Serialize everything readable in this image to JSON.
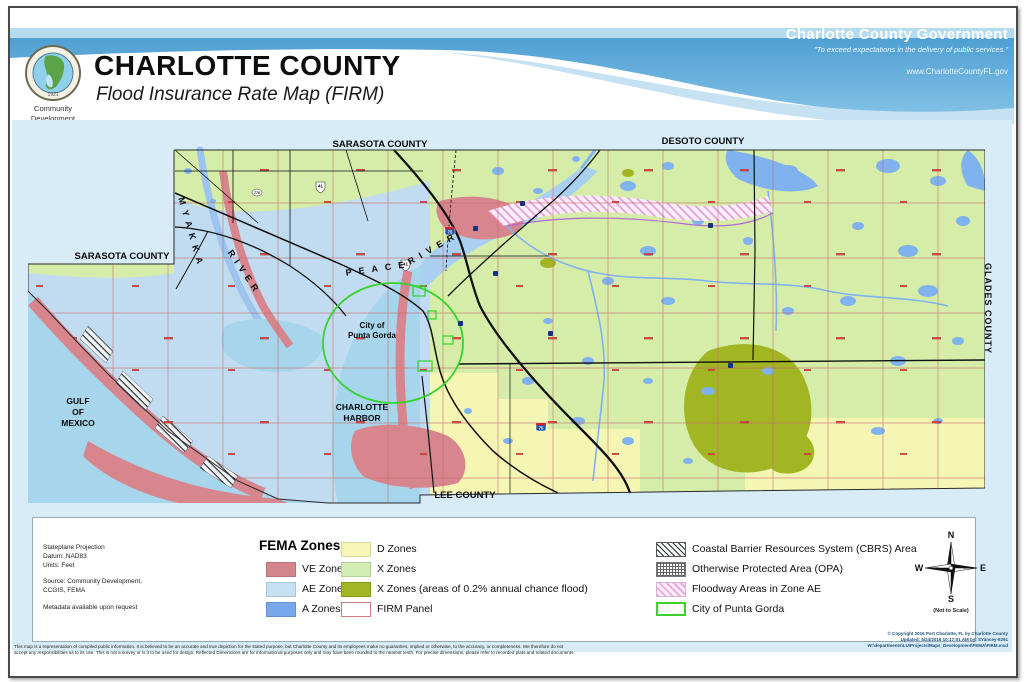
{
  "header": {
    "title": "CHARLOTTE COUNTY",
    "subtitle": "Flood Insurance Rate Map (FIRM)",
    "gov_title": "Charlotte County Government",
    "tagline": "\"To exceed expectations in the delivery of public services.\"",
    "website": "www.CharlotteCountyFL.gov",
    "logo_caption_line1": "Community",
    "logo_caption_line2": "Development",
    "seal_year": "1921"
  },
  "map": {
    "labels": {
      "sarasota_top": "SARASOTA COUNTY",
      "desoto": "DESOTO COUNTY",
      "sarasota_west": "SARASOTA COUNTY",
      "glades": "GLADES COUNTY",
      "lee": "LEE COUNTY",
      "gulf": "GULF\nOF\nMEXICO",
      "harbor": "CHARLOTTE\nHARBOR",
      "punta_gorda": "City of\nPunta Gorda",
      "myakka_word1": "MYAKKA",
      "myakka_word2": "RIVER",
      "peace_word1": "PEACE",
      "peace_word2": "RIVER"
    },
    "shields": {
      "us41": "41",
      "i75": "75",
      "sr776": "776"
    }
  },
  "legend": {
    "heading": "FEMA Zones",
    "info": {
      "projection": "Stateplane Projection",
      "datum": "Datum: NAD83",
      "units": "Units:  Feet",
      "source_line1": "Source: Community Development,",
      "source_line2": "CCGIS, FEMA",
      "metadata": "Metadata available upon request"
    },
    "col1": [
      {
        "label": "VE Zones",
        "color": "#d3858c"
      },
      {
        "label": "AE Zones",
        "color": "#c6e1f4"
      },
      {
        "label": "A Zones",
        "color": "#77a8ee"
      }
    ],
    "col2": [
      {
        "label": "D Zones",
        "color": "#f7f7b8"
      },
      {
        "label": "X Zones",
        "color": "#d2eeb5"
      },
      {
        "label": "X Zones (areas of 0.2% annual chance flood)",
        "color": "#a1b622"
      },
      {
        "label": "FIRM Panel",
        "color": "#ffffff"
      }
    ],
    "col3": [
      {
        "label": "Coastal Barrier Resources System (CBRS) Area",
        "pattern": "black-diagonal-hatch"
      },
      {
        "label": "Otherwise Protected Area (OPA)",
        "pattern": "dotted-grid"
      },
      {
        "label": "Floodway Areas in Zone AE",
        "pattern": "pink-diagonal-hatch"
      },
      {
        "label": "City of Punta Gorda",
        "pattern": "green-outline"
      }
    ],
    "compass": {
      "n": "N",
      "s": "S",
      "e": "E",
      "w": "W",
      "note": "(Not to Scale)"
    }
  },
  "footer": {
    "disclaimer_line1": "This map is a representation of compiled public information.  It is believed to be an accurate and true depiction for the stated purpose, but Charlotte County and its employees make no guaranties, implied or otherwise, to the accuracy, or completeness.  We therefore do not",
    "disclaimer_line2": "accept any responsibilities as to its use.  This is not a survey or is it to be used for design.  Reflected Dimensions are for informational purposes only and may have been rounded to the nearest tenth.  For precise dimensions, please refer to recorded plats and related documents.",
    "copyright_line1": "© Copyright 2016 Port Charlotte, FL by Charlotte County",
    "copyright_line2": "Updated: 5/24/2016 10:17:01 AM  by:  SYancey-9291",
    "copyright_line3": "W:\\departments\\LU\\Projects\\Maps_Development\\FEMA\\FIRM.mxd"
  }
}
